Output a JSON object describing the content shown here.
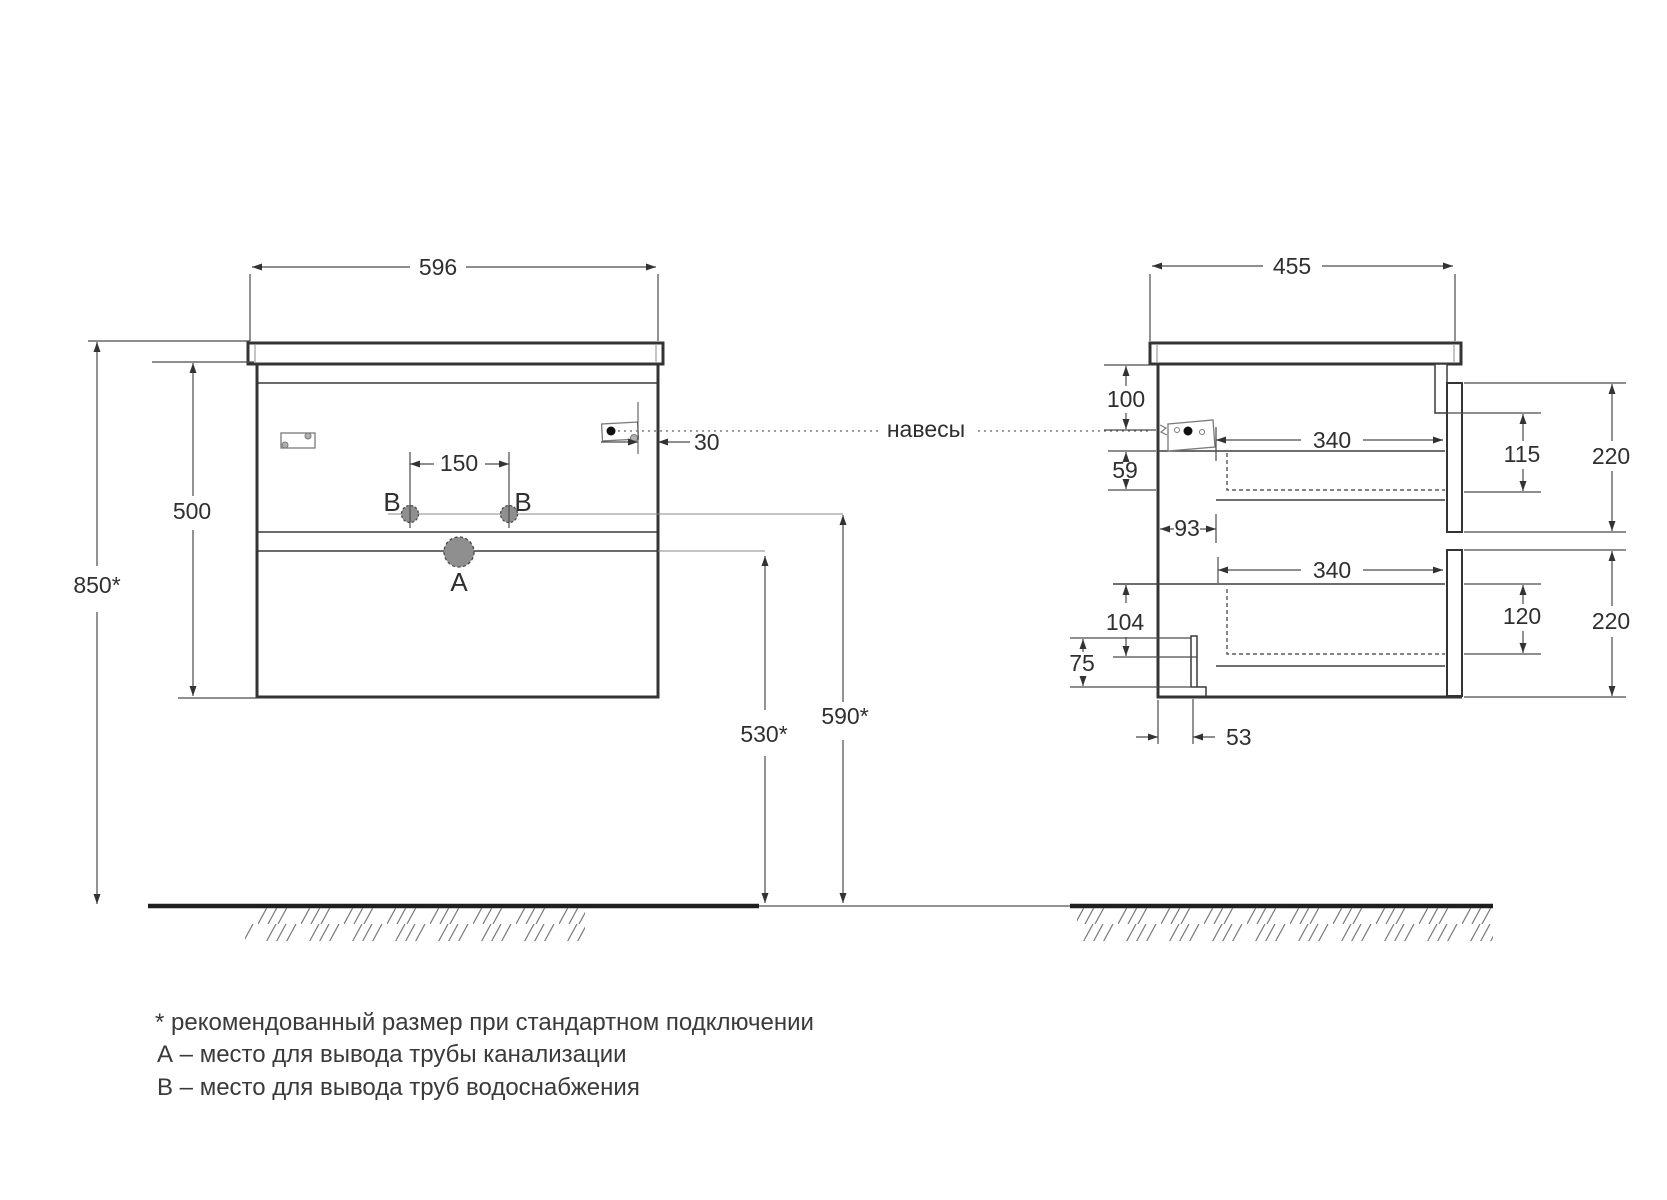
{
  "front_view": {
    "width": "596",
    "carcass_height": "500",
    "worktop_height_from_floor": "850*",
    "faucet_holes_spacing": "150",
    "hanger_edge_offset": "30",
    "drain_outlet_height": "530*",
    "water_supply_height": "590*",
    "drain_point_label": "A",
    "supply_point_label_left": "B",
    "supply_point_label_right": "B"
  },
  "side_view": {
    "depth": "455",
    "hanger_drop_from_top": "100",
    "hanger_to_drawer_gap": "59",
    "back_clearance": "93",
    "upper_drawer_depth": "340",
    "lower_drawer_depth": "340",
    "upper_drawer_inner_height": "115",
    "upper_front_height": "220",
    "lower_drawer_inner_height": "120",
    "lower_front_height": "220",
    "bottom_back_clearance": "104",
    "plinth_recess_height": "75",
    "plinth_recess_depth": "53"
  },
  "annotations": {
    "hangers": "навесы"
  },
  "footnotes": [
    "* рекомендованный размер при стандартном подключении",
    "А – место для вывода трубы канализации",
    "В – место для вывода труб водоснабжения"
  ],
  "colors": {
    "outline": "#343434",
    "dim_line": "#4a4a4a",
    "floor": "#1f1f1f",
    "hole_fill": "#8f8f8f",
    "background": "#ffffff"
  }
}
